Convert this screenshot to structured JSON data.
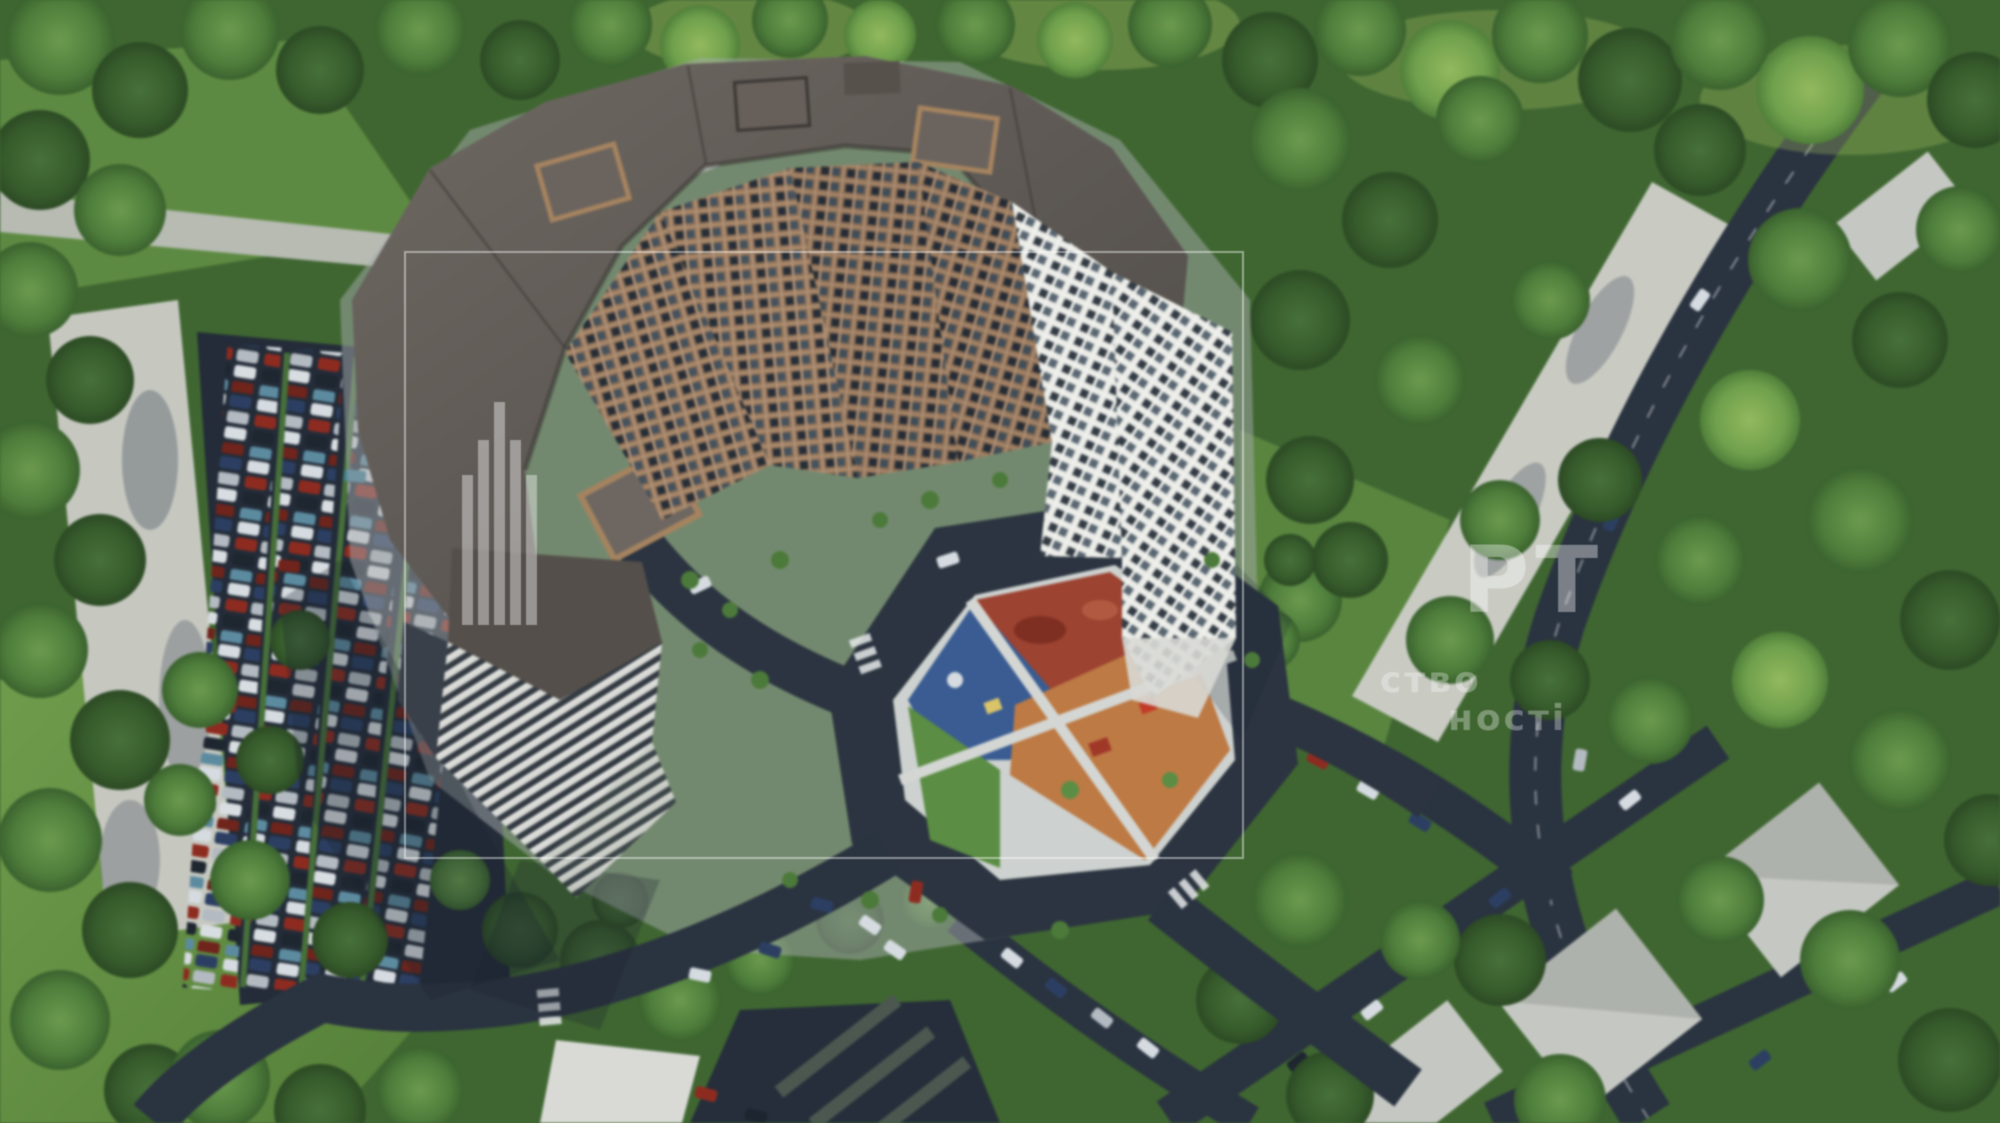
{
  "image": {
    "kind": "aerial-architectural-rendering",
    "description": "Bird's-eye 3D render of a large residential complex: a ring of bronze- and white-framed high-rise towers with dark flat roofs around a courtyard playground (red, blue, green and orange zones), a big open-air parking lot with rows of cars on the west side, asphalt streets with parked cars, low suburban houses with light roofs to the south-east, all surrounded by dense green forest. A translucent real-estate agency watermark (frame, bar logo and Cyrillic text) lies over the picture.",
    "width_px": 2000,
    "height_px": 1123
  },
  "watermark": {
    "name": "real-estate-agency-watermark",
    "frame_visible": true,
    "logo": "vertical-bars-building-logo",
    "large_text_fragment": "РТ",
    "small_text_line1_fragment": "ство",
    "small_text_line2_fragment": "ності",
    "color": "#ffffff"
  },
  "scene_regions": {
    "residential_complex": "multi-tower residential complex, bronze and white facades",
    "courtyard_playground": "courtyard island with red, blue, green, orange playground zones",
    "parking_lot_west": "open parking with rows of multicolored cars",
    "forest": "dense trees around the site",
    "streets": "dark asphalt streets with cars",
    "suburban_houses_southeast": "low houses with light gray roofs among trees"
  },
  "palette": {
    "tree_green_dark": "#2f5226",
    "tree_green_mid": "#4e7d3b",
    "tree_green_light": "#6fa04c",
    "grass": "#679547",
    "asphalt": "#2a3340",
    "sidewalk": "#b9bdb7",
    "roof_dark": "#57514c",
    "facade_bronze": "#93745a",
    "facade_white": "#e5e6e2",
    "window_glass": "#2e3640",
    "playground_red": "#9c4331",
    "playground_blue": "#3a5c92",
    "playground_orange": "#bd7a44",
    "playground_green": "#5b8d44",
    "path_white": "#cdd1cf",
    "car_red": "#8e2b20",
    "car_blue": "#2c3f63",
    "car_white": "#d5dbe0"
  }
}
